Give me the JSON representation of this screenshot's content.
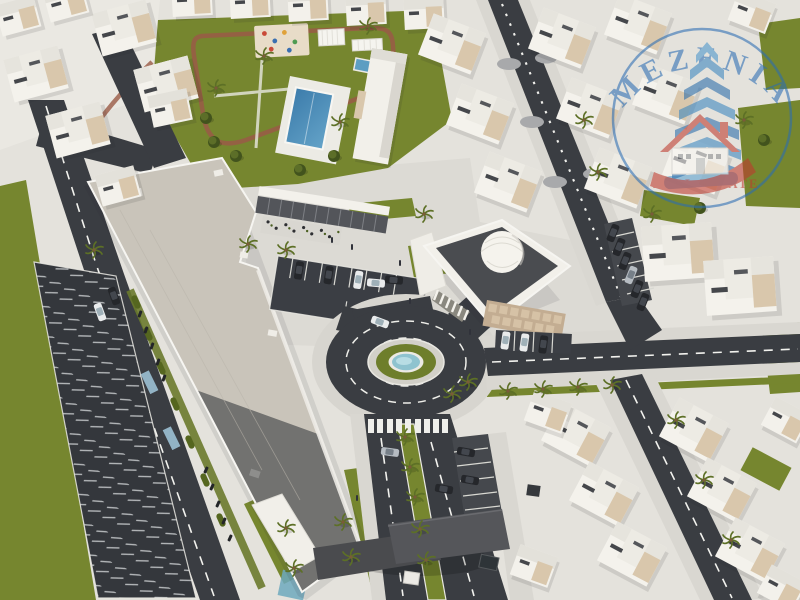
{
  "description": "Aerial 3D architectural rendering of a residential community master plan: rows of white villas, a large shopping mall, a domed mosque, a landscaped park with swimming pool, playground and jogging track, a central roundabout with a circular fountain, palm-lined roads, surface parking lots and scattered cars.",
  "watermark": {
    "brand": "MEZENIA",
    "tagline": "REAL ESTATE"
  },
  "scene": {
    "landmarks": [
      "villas",
      "shopping-mall",
      "mosque-with-dome",
      "roundabout-fountain",
      "community-park",
      "swimming-pool",
      "playground",
      "jogging-track",
      "surface-parking-lot",
      "entrance-gate-canopy",
      "palm-trees",
      "parked-cars"
    ],
    "colors": {
      "asphalt": "#3a3d42",
      "road_marking": "#f2f2ee",
      "pavement": "#d9d7d1",
      "ground": "#e4e2dc",
      "grass": "#76862f",
      "hedge": "#55661f",
      "building_white": "#f4f2ec",
      "building_beige": "#d9c7ac",
      "mall_roof_north": "#c9c4ba",
      "mall_roof_south": "#727270",
      "mosque_roof": "#4a4c50",
      "pool_blue": "#3f7fae",
      "fountain_teal": "#8fc3cf",
      "track_red": "#9a5a46",
      "logo_blue": "#2b6db3",
      "logo_red": "#bf3a2e"
    }
  }
}
